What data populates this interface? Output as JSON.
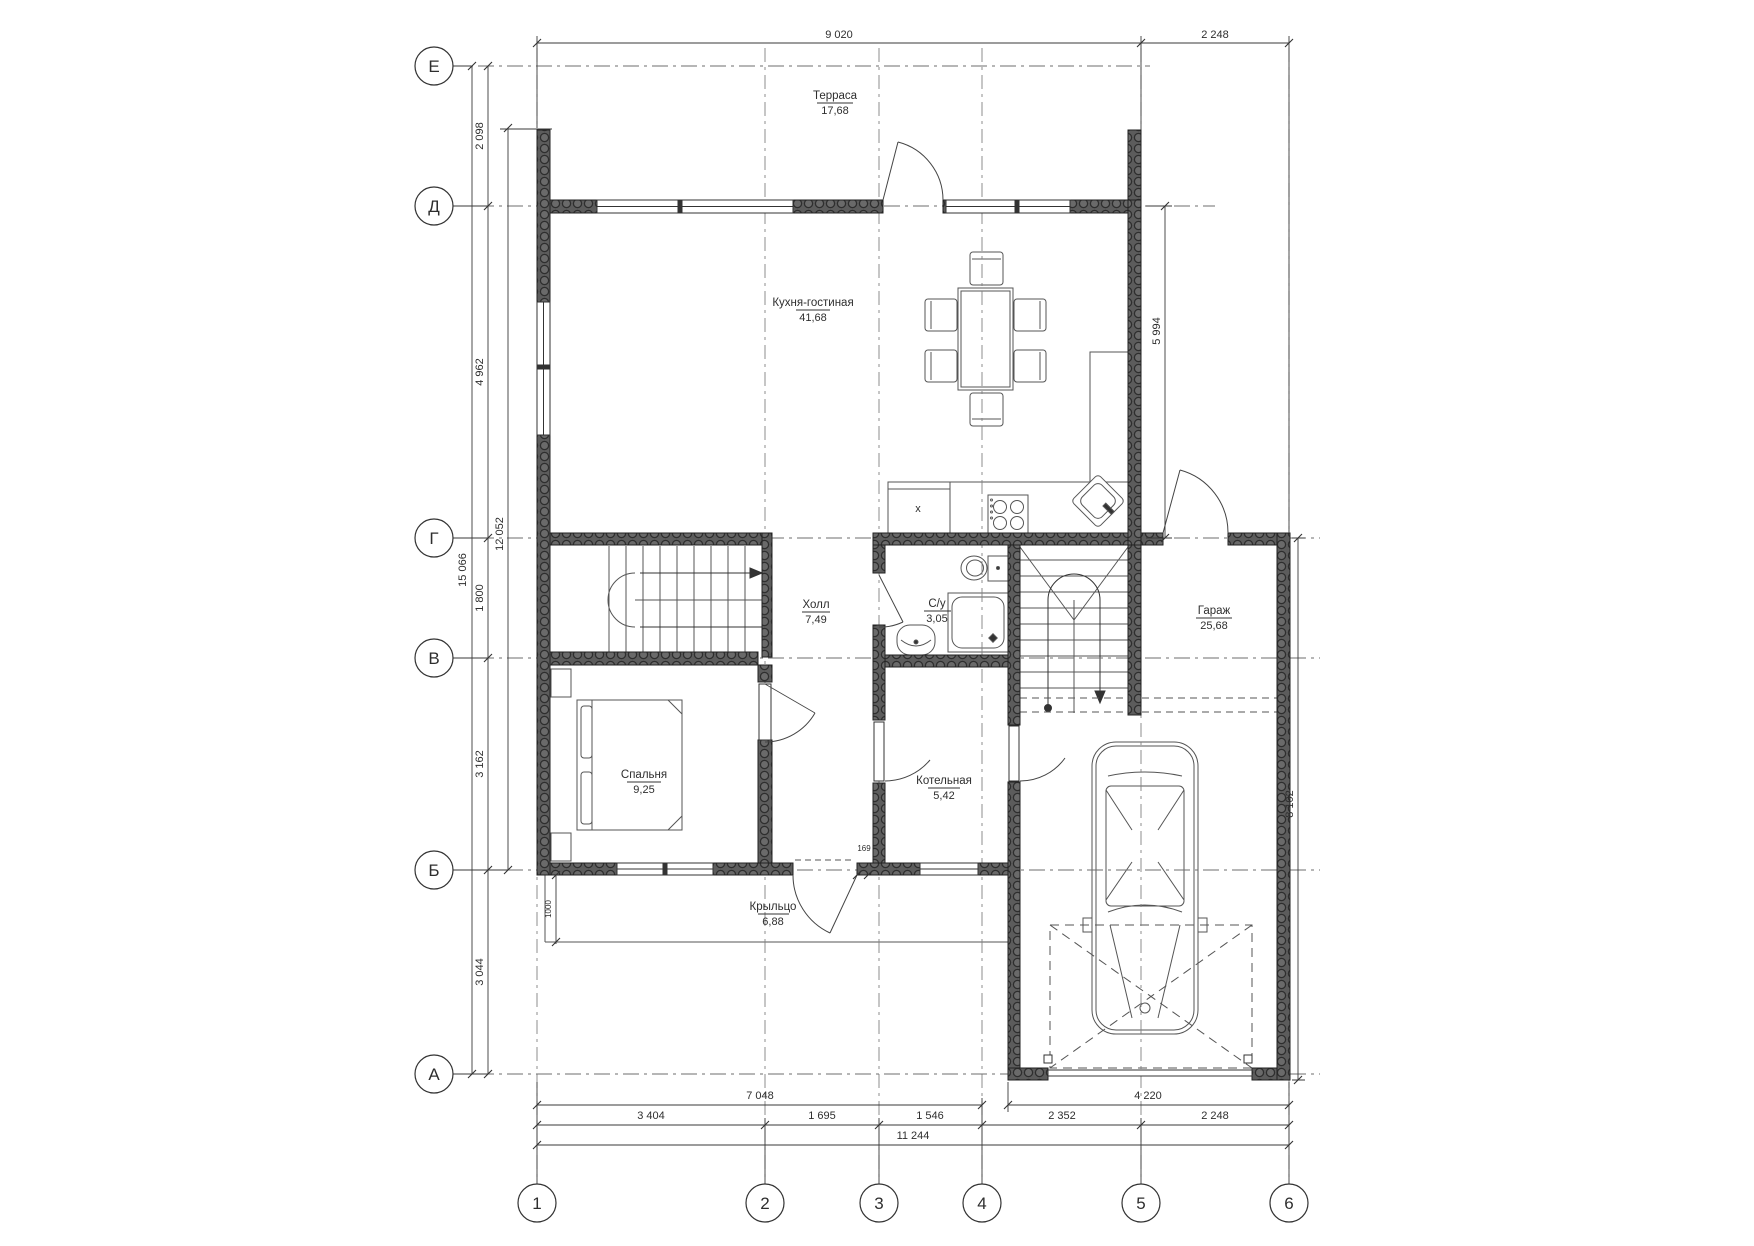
{
  "axes": {
    "rows": [
      "Е",
      "Д",
      "Г",
      "В",
      "Б",
      "А"
    ],
    "cols": [
      "1",
      "2",
      "3",
      "4",
      "5",
      "6"
    ]
  },
  "rooms": [
    {
      "name": "Терраса",
      "area": "17,68"
    },
    {
      "name": "Кухня-гостиная",
      "area": "41,68"
    },
    {
      "name": "Холл",
      "area": "7,49"
    },
    {
      "name": "С/у",
      "area": "3,05"
    },
    {
      "name": "Гараж",
      "area": "25,68"
    },
    {
      "name": "Спальня",
      "area": "9,25"
    },
    {
      "name": "Котельная",
      "area": "5,42"
    },
    {
      "name": "Крыльцо",
      "area": "6,88"
    }
  ],
  "dims": {
    "top": [
      "9 020",
      "2 248"
    ],
    "left_chain": [
      "2 098",
      "4 962",
      "1 800",
      "3 162",
      "3 044"
    ],
    "left_total_1": "12 052",
    "left_total_2": "15 066",
    "right_1": "5 994",
    "right_2": "8 102",
    "bottom_row1": [
      "7 048",
      "4 220"
    ],
    "bottom_row2": [
      "3 404",
      "1 695",
      "1 546",
      "2 352",
      "2 248"
    ],
    "bottom_total": "11 244",
    "small_1": "1000",
    "small_2": "169"
  },
  "marks": {
    "appliance": "х"
  }
}
